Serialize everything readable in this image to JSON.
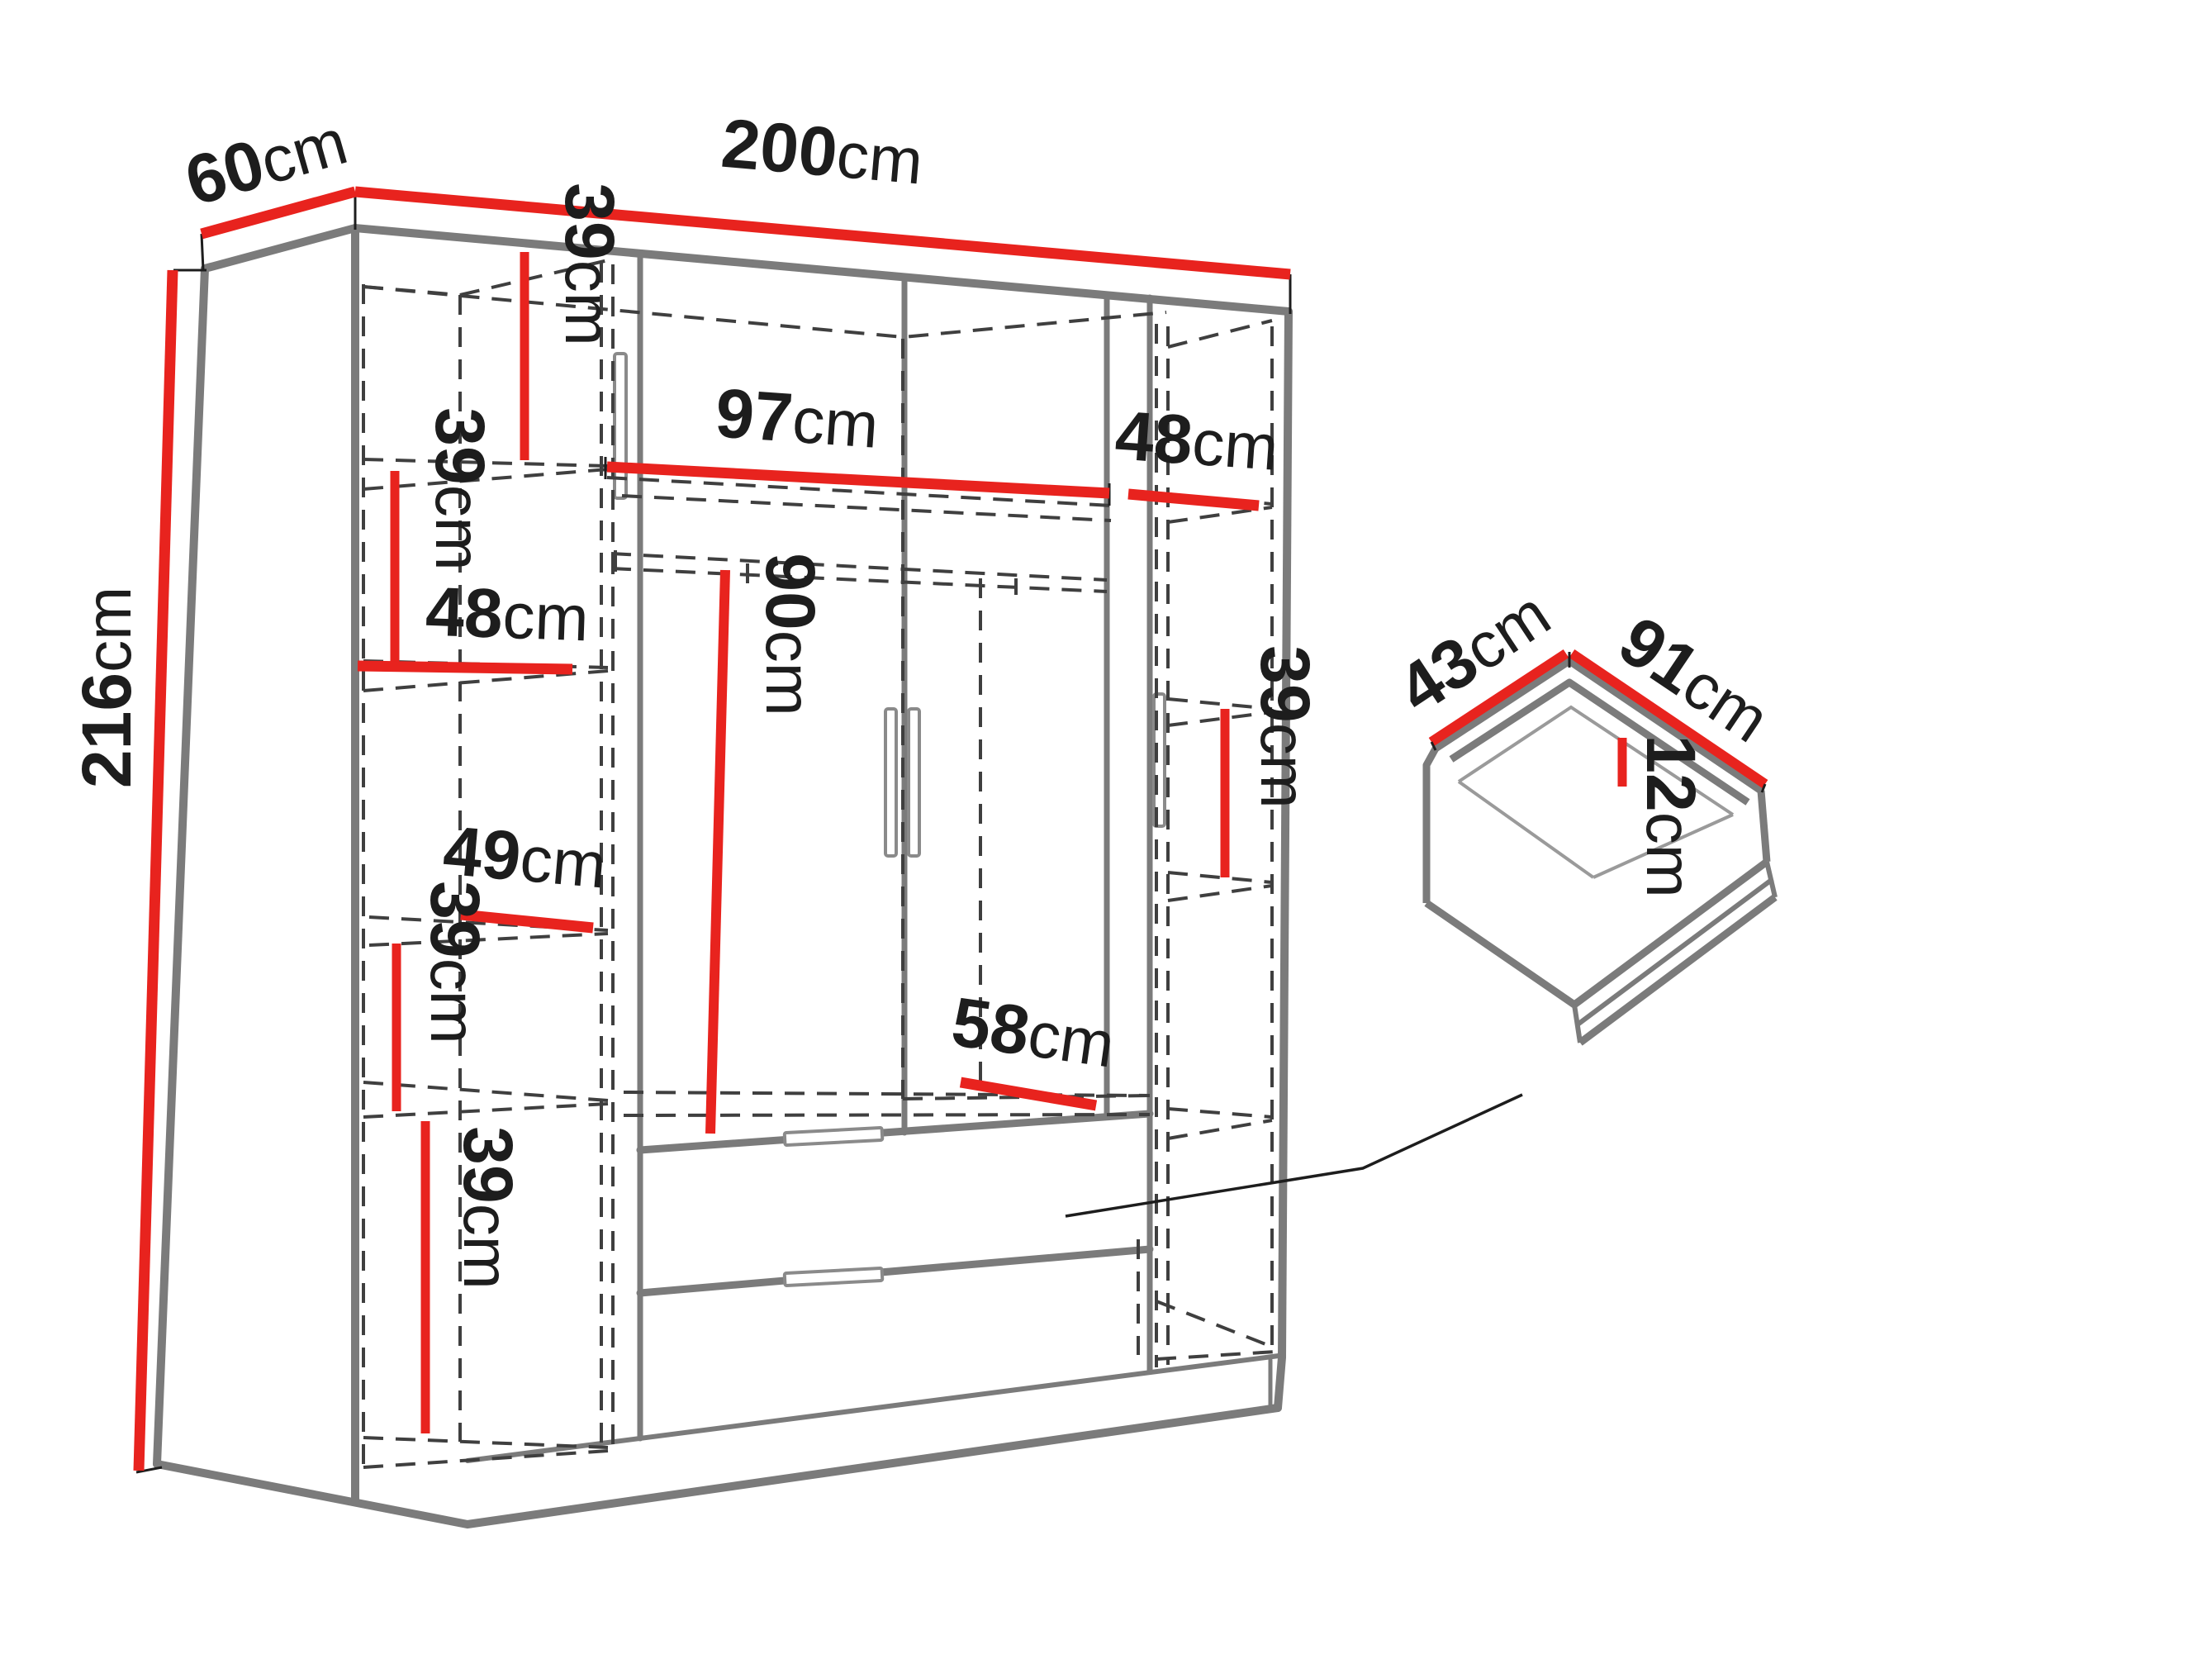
{
  "meta": {
    "background": "#ffffff",
    "accent_red": "#e8231e",
    "outline_gray": "#7b7b7b",
    "dash_gray": "#3f3f3f",
    "text_black": "#1d1d1d"
  },
  "dimensions": {
    "depth_top": {
      "num": "60",
      "unit": "cm"
    },
    "width_top": {
      "num": "200",
      "unit": "cm"
    },
    "height_left": {
      "num": "216",
      "unit": "cm"
    },
    "left_gap_1": {
      "num": "39",
      "unit": "cm"
    },
    "center_width": {
      "num": "97",
      "unit": "cm"
    },
    "right_shelf_width": {
      "num": "48",
      "unit": "cm"
    },
    "left_gap_2": {
      "num": "39",
      "unit": "cm"
    },
    "left_shelf_width_1": {
      "num": "48",
      "unit": "cm"
    },
    "left_shelf_width_2": {
      "num": "49",
      "unit": "cm"
    },
    "left_gap_3": {
      "num": "39",
      "unit": "cm"
    },
    "left_gap_4": {
      "num": "39",
      "unit": "cm"
    },
    "hanging_height": {
      "num": "90",
      "unit": "cm"
    },
    "bottom_shelf_width": {
      "num": "58",
      "unit": "cm"
    },
    "right_gap": {
      "num": "39",
      "unit": "cm"
    },
    "drawer_depth": {
      "num": "43",
      "unit": "cm"
    },
    "drawer_width": {
      "num": "91",
      "unit": "cm"
    },
    "drawer_height": {
      "num": "12",
      "unit": "cm"
    }
  }
}
